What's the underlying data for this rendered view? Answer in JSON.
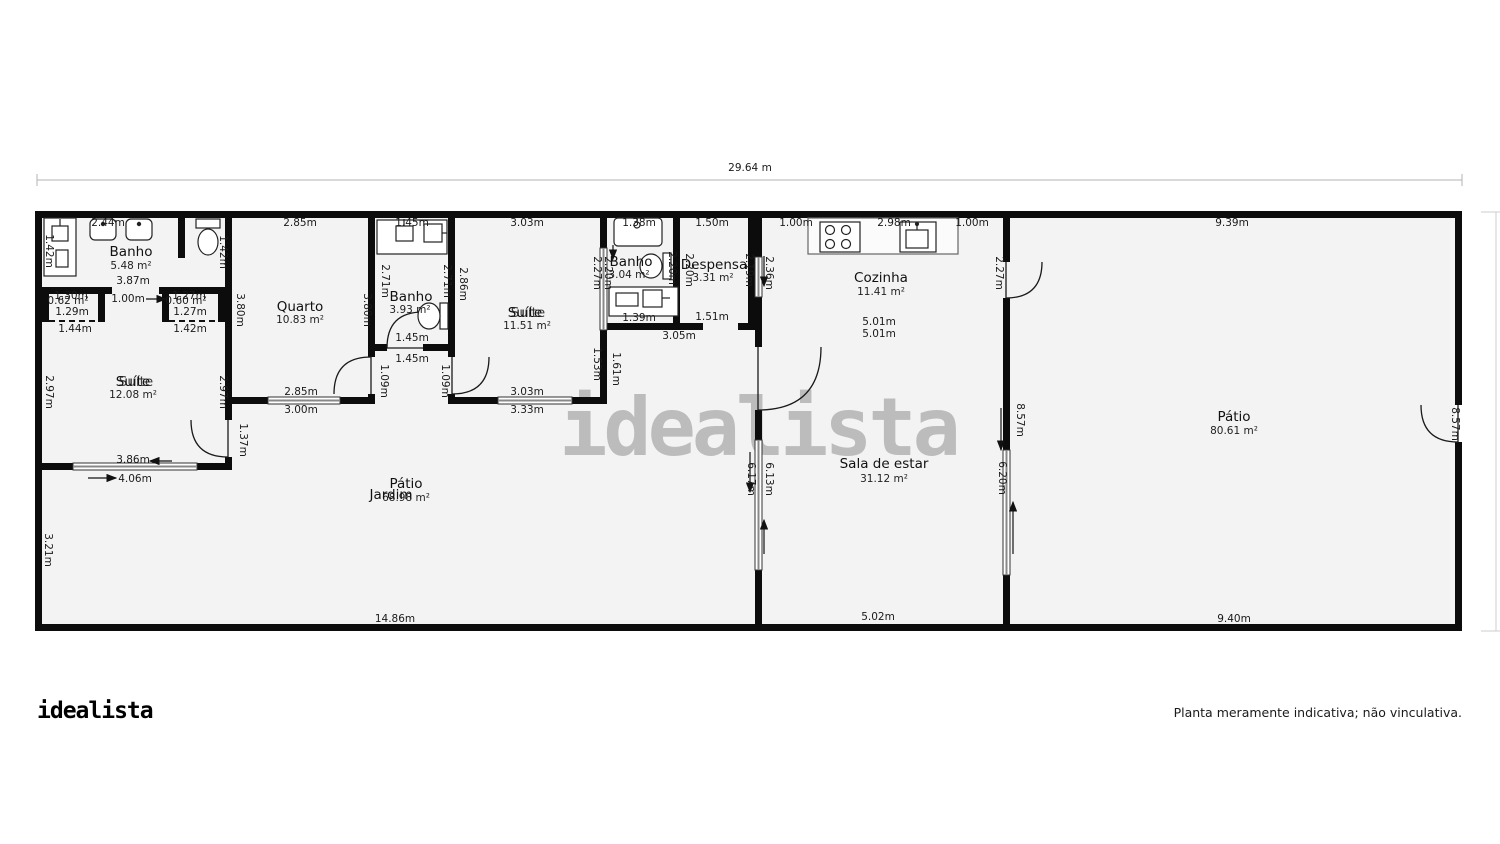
{
  "branding": {
    "logo": "idealista",
    "watermark": "idealista",
    "disclaimer": "Planta meramente indicativa; não vinculativa."
  },
  "rooms": [
    {
      "name": "Banho",
      "area": "5.48 m²"
    },
    {
      "name": "Suíte",
      "area": "12.08 m²"
    },
    {
      "name": "Quarto",
      "area": "10.83 m²"
    },
    {
      "name": "Banho",
      "area": "3.93 m²"
    },
    {
      "name": "Suíte",
      "area": "11.51 m²"
    },
    {
      "name": "Banho",
      "area": "3.04 m²"
    },
    {
      "name": "Despensa",
      "area": "3.31 m²"
    },
    {
      "name": "Cozinha",
      "area": "11.41 m²"
    },
    {
      "name": "Sala de estar",
      "area": "31.12 m²"
    },
    {
      "name": "Pátio",
      "area": "80.61 m²"
    },
    {
      "name": "Pátio",
      "area": "68.98 m²"
    },
    {
      "name": "Jardim",
      "area": ""
    }
  ],
  "dims": [
    "29.64 m",
    "2.44m",
    "1.42m",
    "1.42m",
    "3.87m",
    "1.30m",
    "0.62 m²",
    "1.29m",
    "1.44m",
    "1.00m",
    "1.27m",
    "0.60 m²",
    "1.27m",
    "1.42m",
    "2.97m",
    "2.97m",
    "1.37m",
    "3.86m",
    "4.06m",
    "3.21m",
    "14.86m",
    "2.85m",
    "3.80m",
    "3.80m",
    "2.85m",
    "3.00m",
    "1.45m",
    "2.71m",
    "2.71m",
    "1.45m",
    "1.45m",
    "1.09m",
    "1.09m",
    "3.03m",
    "2.86m",
    "2.27m",
    "2.20m",
    "1.53m",
    "3.03m",
    "3.33m",
    "1.61m",
    "3.05m",
    "1.38m",
    "2.20m",
    "1.39m",
    "1.50m",
    "2.20m",
    "2.19m",
    "1.51m",
    "2.36m",
    "1.00m",
    "2.98m",
    "1.00m",
    "2.27m",
    "5.01m",
    "5.01m",
    "6.17m",
    "6.13m",
    "8.57m",
    "6.20m",
    "5.02m",
    "9.39m",
    "9.40m",
    "8.57m"
  ],
  "icons": [
    "sink",
    "toilet",
    "shower",
    "vanity",
    "stove",
    "kitchen-sink"
  ],
  "colors": {
    "wall": "#0c0c0c",
    "floor": "#f3f3f3",
    "dim_text": "#1a1a1a",
    "dim_line": "#b3b3b3",
    "watermark": "#bcbcbc"
  }
}
